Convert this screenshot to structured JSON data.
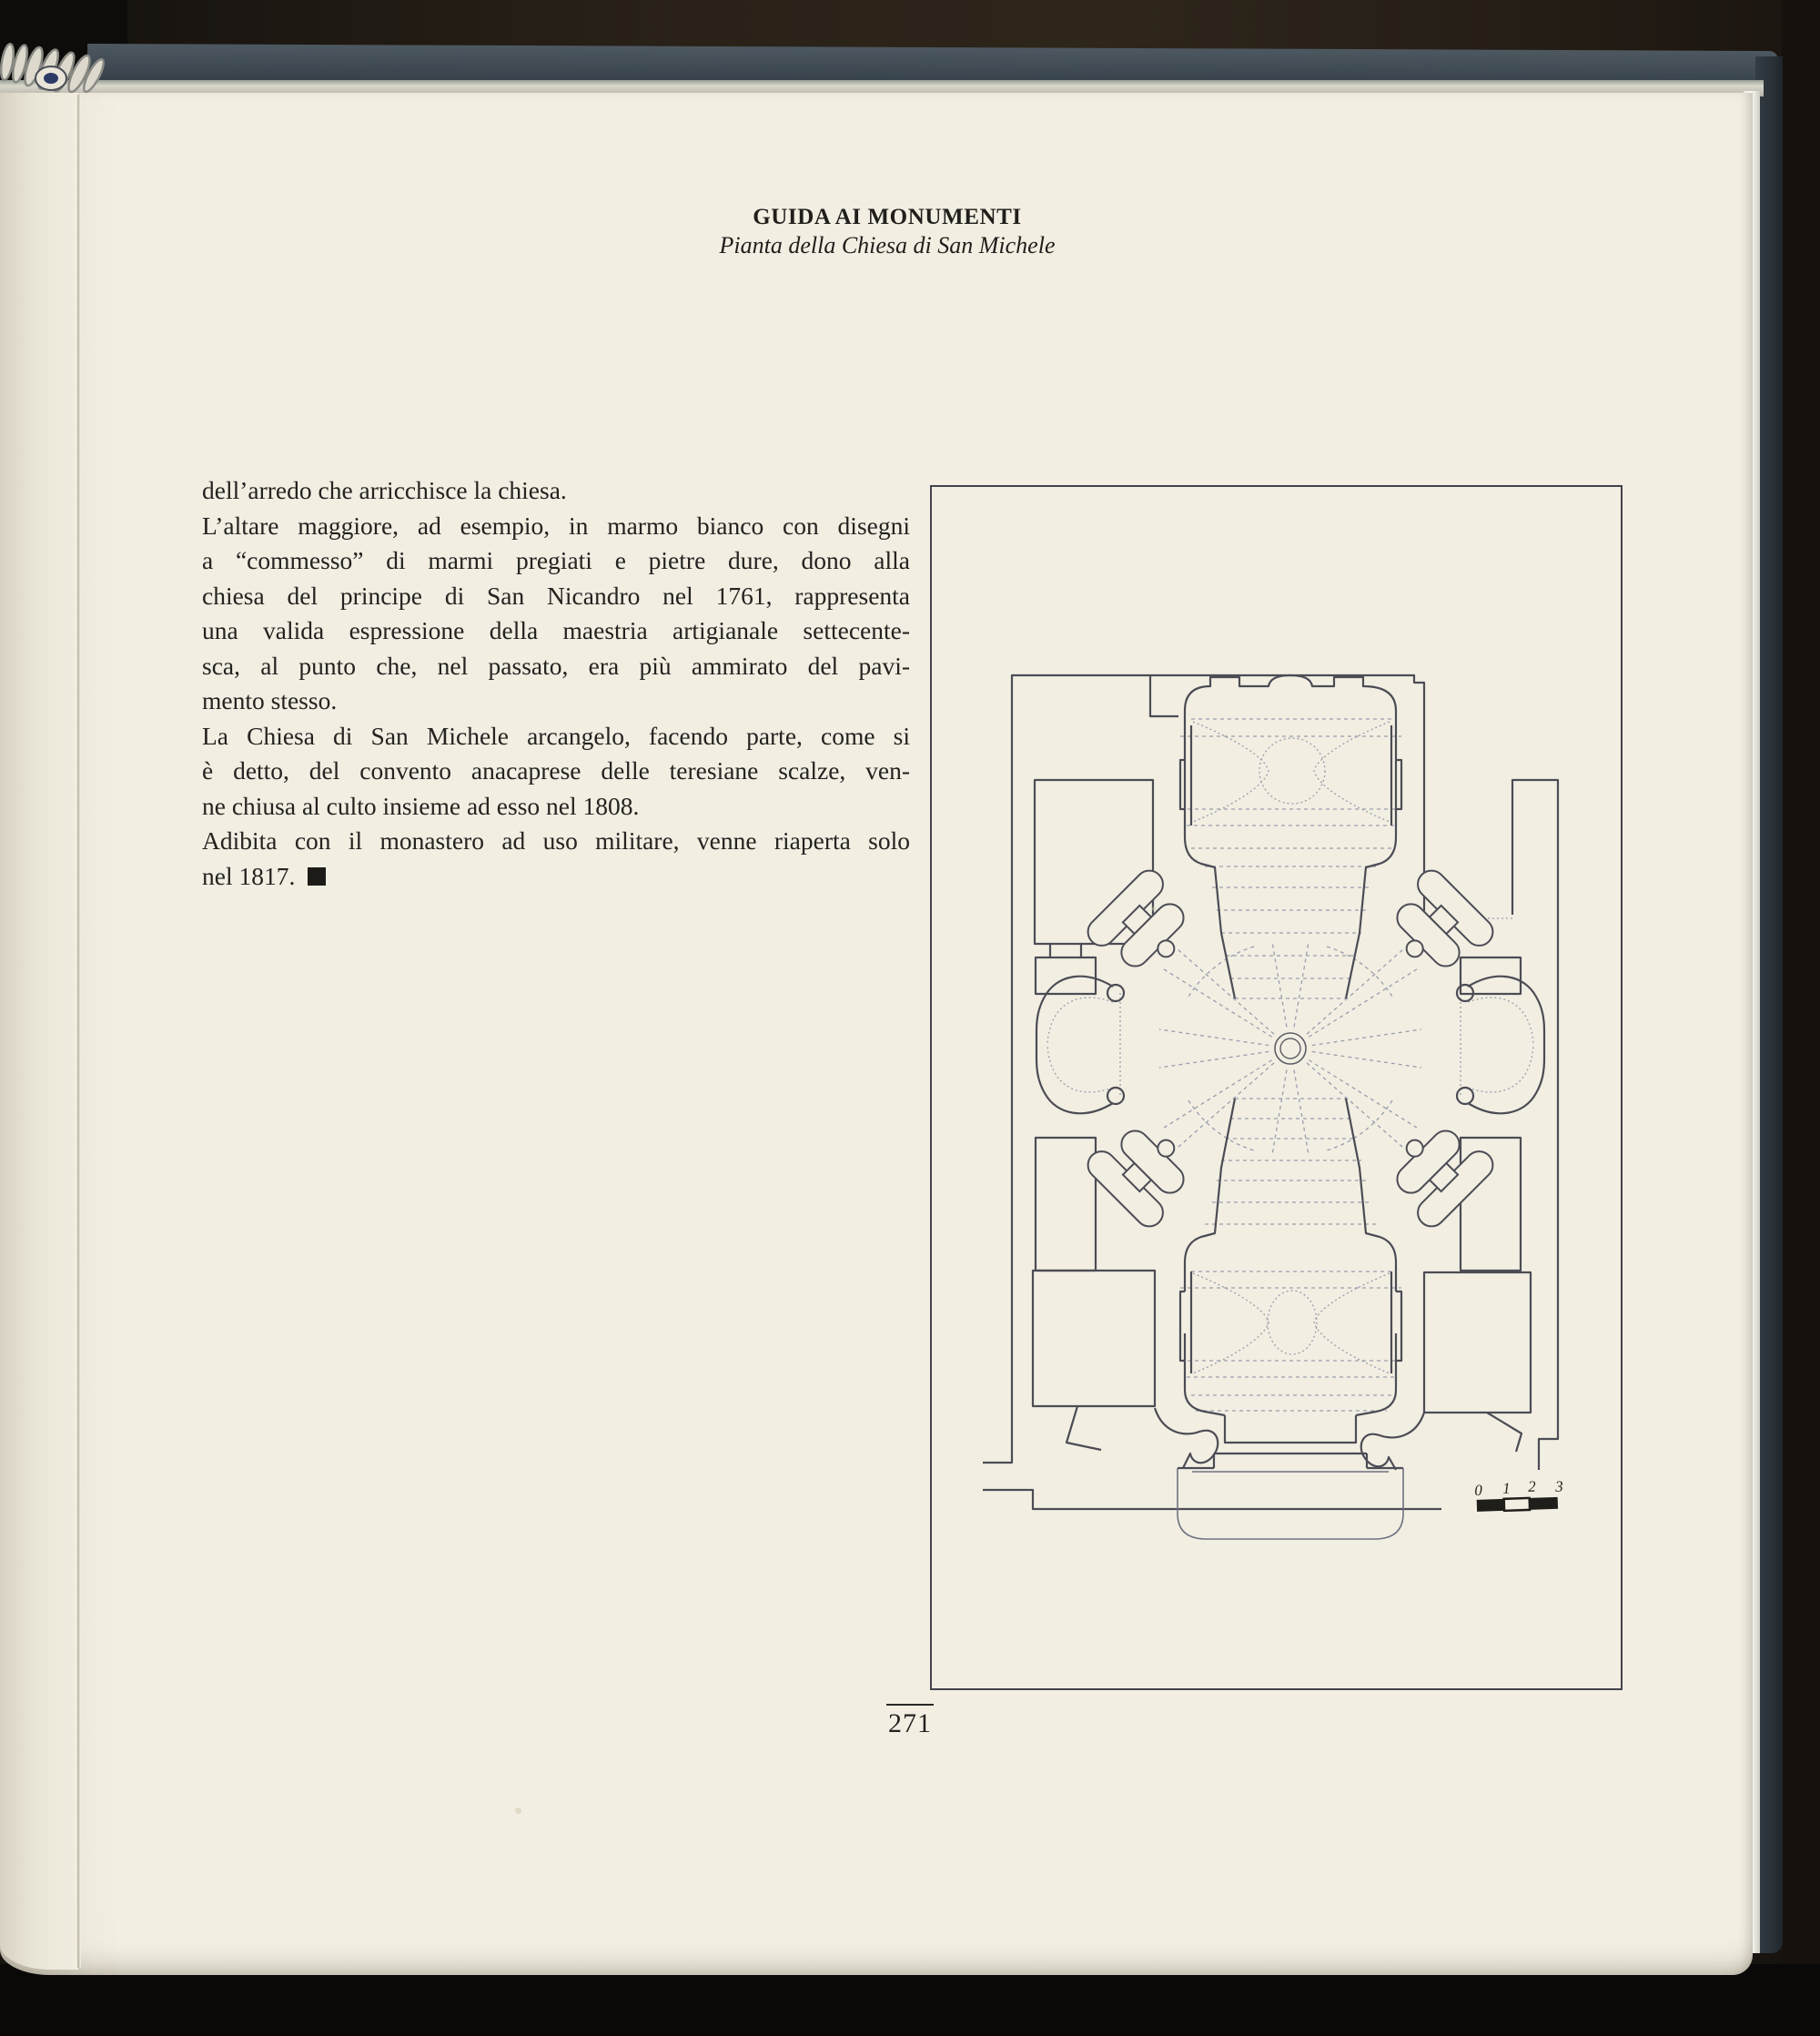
{
  "page": {
    "header": {
      "title": "GUIDA AI MONUMENTI",
      "subtitle": "Pianta della Chiesa di San Michele"
    },
    "body": {
      "lines": [
        {
          "text": "dell’arredo che arricchisce la chiesa.",
          "justify": false,
          "square": false
        },
        {
          "text": "L’altare maggiore, ad esempio, in marmo bianco con disegni",
          "justify": true,
          "square": false
        },
        {
          "text": "a “commesso” di marmi pregiati e pietre dure, dono alla",
          "justify": true,
          "square": false
        },
        {
          "text": "chiesa del principe di San Nicandro nel 1761, rappresenta",
          "justify": true,
          "square": false
        },
        {
          "text": "una valida espressione della maestria artigianale settecente-",
          "justify": true,
          "square": false
        },
        {
          "text": "sca, al punto che, nel passato, era più ammirato del pavi-",
          "justify": true,
          "square": false
        },
        {
          "text": "mento stesso.",
          "justify": false,
          "square": false
        },
        {
          "text": "La Chiesa di San Michele arcangelo, facendo parte, come si",
          "justify": true,
          "square": false
        },
        {
          "text": "è detto, del convento anacaprese delle teresiane scalze, ven-",
          "justify": true,
          "square": false
        },
        {
          "text": "ne chiusa al culto insieme ad esso nel 1808.",
          "justify": false,
          "square": false
        },
        {
          "text": "Adibita con il monastero ad uso militare, venne riaperta solo",
          "justify": true,
          "square": false
        },
        {
          "text": "nel 1817.",
          "justify": false,
          "square": true
        }
      ]
    },
    "figure": {
      "scale_labels": [
        "0",
        "1",
        "2",
        "3"
      ]
    },
    "footer": {
      "page_number": "271"
    },
    "colors": {
      "paper": "#f2eee2",
      "cover_blue": "#3e4952",
      "ink": "#242320",
      "plan_wall": "#4c4c55",
      "plan_light": "#989eab"
    }
  }
}
